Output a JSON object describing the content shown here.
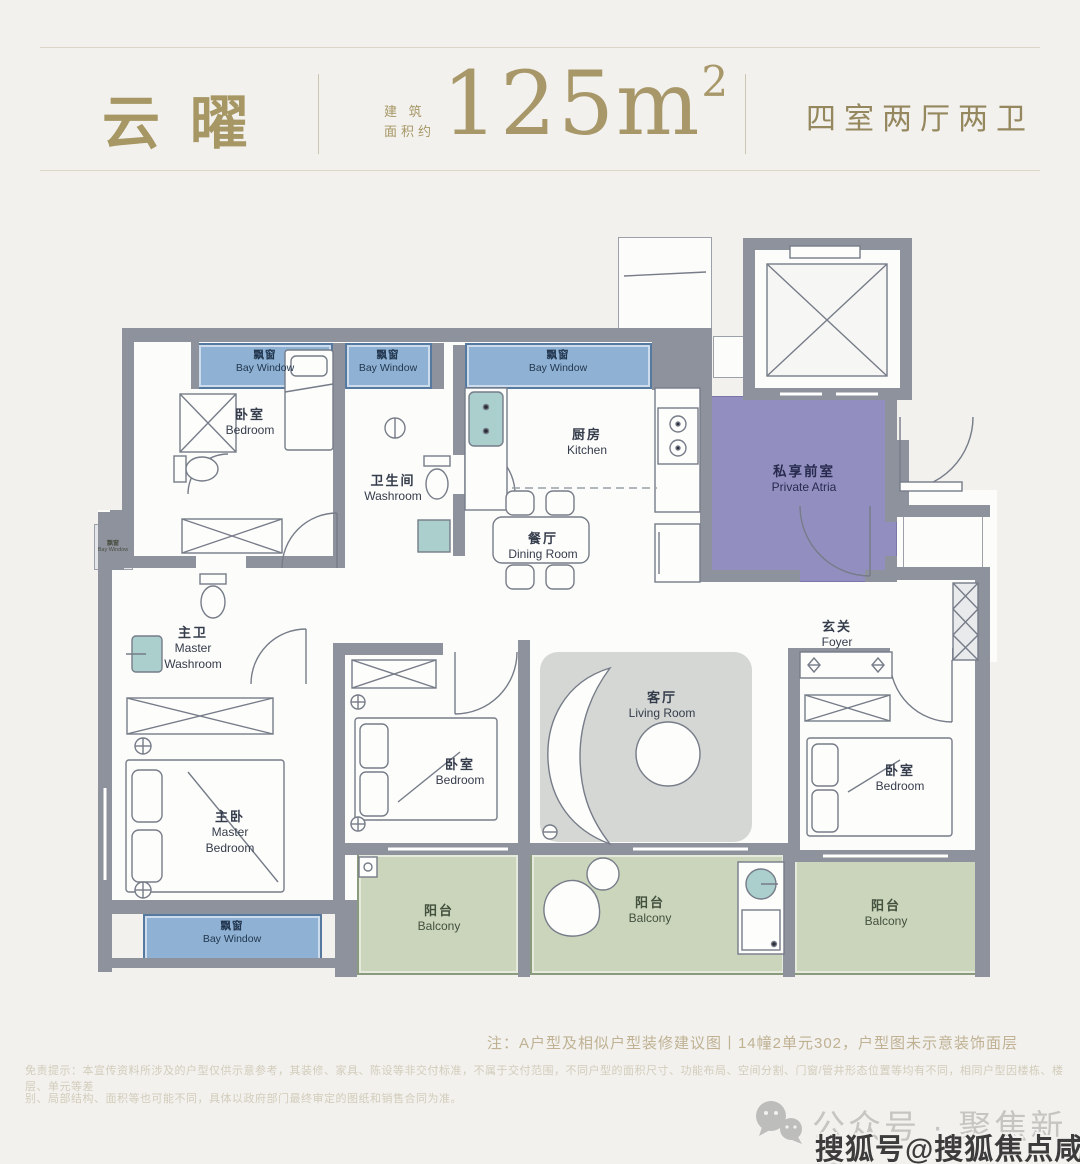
{
  "header": {
    "title": "云曜",
    "area_prefix_line1": "建 筑",
    "area_prefix_line2": "面积约",
    "area_value": "125m",
    "area_sup": "2",
    "layout": "四室两厅两卫"
  },
  "plan": {
    "rooms": {
      "bay_top1": {
        "cn": "飘窗",
        "en": "Bay Window"
      },
      "bay_top2": {
        "cn": "飘窗",
        "en": "Bay Window"
      },
      "bay_top3": {
        "cn": "飘窗",
        "en": "Bay Window"
      },
      "bay_left": {
        "cn": "飘窗",
        "en": "Bay Window"
      },
      "bay_bottom": {
        "cn": "飘窗",
        "en": "Bay Window"
      },
      "bedroom_tl": {
        "cn": "卧室",
        "en": "Bedroom"
      },
      "washroom": {
        "cn": "卫生间",
        "en": "Washroom"
      },
      "kitchen": {
        "cn": "厨房",
        "en": "Kitchen"
      },
      "dining": {
        "cn": "餐厅",
        "en": "Dining Room"
      },
      "atria": {
        "cn": "私享前室",
        "en": "Private Atria"
      },
      "foyer": {
        "cn": "玄关",
        "en": "Foyer"
      },
      "master_wash": {
        "cn": "主卫",
        "en": "Master\nWashroom"
      },
      "master_bed": {
        "cn": "主卧",
        "en": "Master\nBedroom"
      },
      "bedroom_mid": {
        "cn": "卧室",
        "en": "Bedroom"
      },
      "living": {
        "cn": "客厅",
        "en": "Living Room"
      },
      "bedroom_r": {
        "cn": "卧室",
        "en": "Bedroom"
      },
      "balcony_l": {
        "cn": "阳台",
        "en": "Balcony"
      },
      "balcony_m": {
        "cn": "阳台",
        "en": "Balcony"
      },
      "balcony_r": {
        "cn": "阳台",
        "en": "Balcony"
      }
    }
  },
  "notes": {
    "plan_note": "注：A户型及相似户型装修建议图丨14幢2单元302，户型图未示意装饰面层",
    "disclaimer_line1": "免责提示：本宣传资料所涉及的户型仅供示意参考，其装修、家具、陈设等非交付标准，不属于交付范围，不同户型的面积尺寸、功能布局、空间分割、门窗/管井形态位置等均有不同，相同户型因楼栋、楼层、单元等差",
    "disclaimer_line2": "别、局部结构、面积等也可能不同，具体以政府部门最终审定的图纸和销售合同为准。"
  },
  "footer": {
    "wechat_label": "公众号 · 聚焦新房",
    "watermark": "搜狐号@搜狐焦点咸宁站"
  },
  "colors": {
    "accent_gold": "#a69764",
    "bay_blue": "#8fb2d4",
    "atria_purple": "#928fc0",
    "balcony_green": "#cbd5bb",
    "wall_gray": "#8e929d"
  }
}
